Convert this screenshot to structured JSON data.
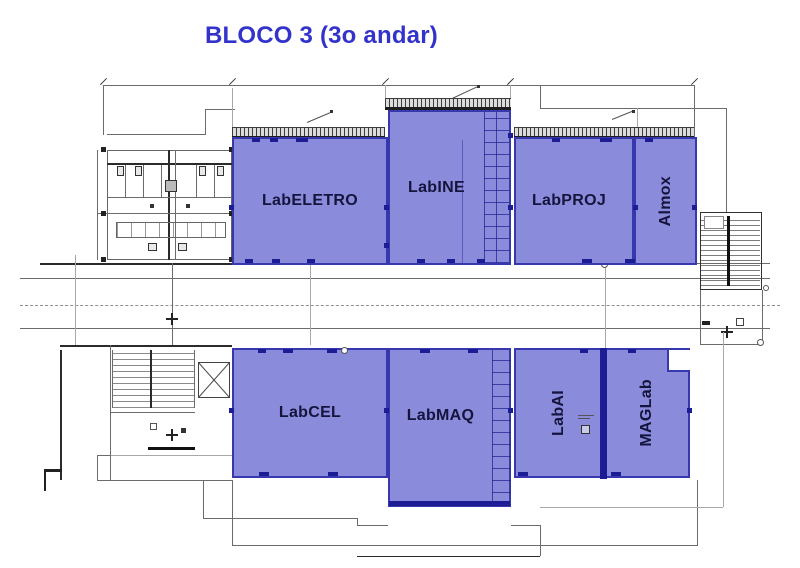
{
  "title": {
    "text": "BLOCO 3 (3o andar)"
  },
  "colors": {
    "title": "#3333cc",
    "room-fill": "#8b8bdb",
    "room-border": "#3737ae",
    "room-dark": "#1c1c94",
    "plan-line": "#6b6b6b",
    "label": "#14143c"
  },
  "rooms": [
    {
      "name": "LabELETRO",
      "orientation": "horizontal"
    },
    {
      "name": "LabINE",
      "orientation": "horizontal"
    },
    {
      "name": "LabPROJ",
      "orientation": "horizontal"
    },
    {
      "name": "Almox",
      "orientation": "vertical"
    },
    {
      "name": "LabCEL",
      "orientation": "horizontal"
    },
    {
      "name": "LabMAQ",
      "orientation": "horizontal"
    },
    {
      "name": "LabAI",
      "orientation": "vertical"
    },
    {
      "name": "MAGLab",
      "orientation": "vertical"
    }
  ]
}
